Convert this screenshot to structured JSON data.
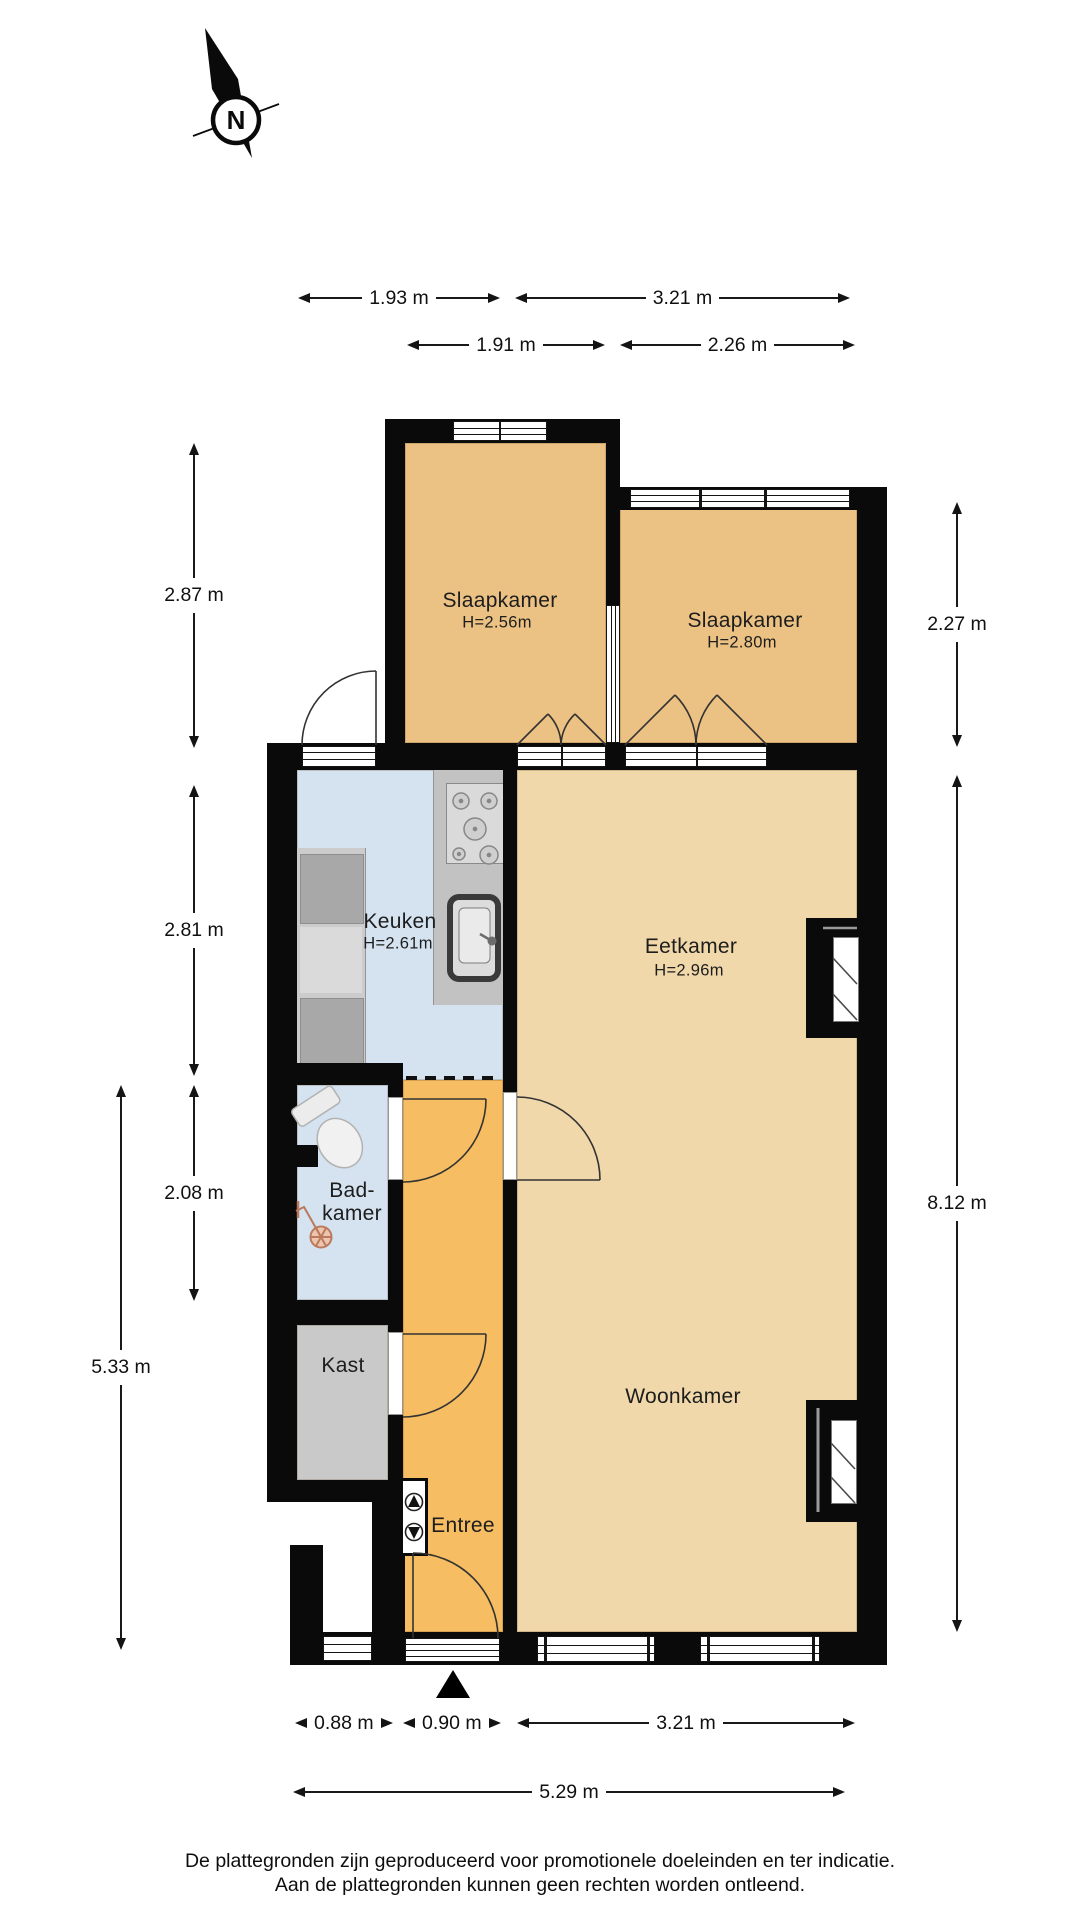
{
  "compass": {
    "letter": "N"
  },
  "rooms": {
    "slaapkamer1": {
      "name": "Slaapkamer",
      "ceiling": "H=2.56m"
    },
    "slaapkamer2": {
      "name": "Slaapkamer",
      "ceiling": "H=2.80m"
    },
    "keuken": {
      "name": "Keuken",
      "ceiling": "H=2.61m"
    },
    "eetkamer": {
      "name": "Eetkamer",
      "ceiling": "H=2.96m"
    },
    "badkamer": {
      "name_line1": "Bad-",
      "name_line2": "kamer"
    },
    "kast": {
      "name": "Kast"
    },
    "woonkamer": {
      "name": "Woonkamer"
    },
    "entree": {
      "name": "Entree"
    }
  },
  "dimensions": {
    "top_row1_left": "1.93 m",
    "top_row1_right": "3.21 m",
    "top_row2_left": "1.91 m",
    "top_row2_right": "2.26 m",
    "left_bedroom": "2.87 m",
    "left_kitchen": "2.81 m",
    "left_bathroom": "2.08 m",
    "left_total": "5.33 m",
    "right_bedroom": "2.27 m",
    "right_living": "8.12 m",
    "bottom_window": "0.88 m",
    "bottom_door": "0.90 m",
    "bottom_living": "3.21 m",
    "bottom_total": "5.29 m"
  },
  "footer": {
    "line1": "De plattegronden zijn geproduceerd voor promotionele doeleinden en ter indicatie.",
    "line2": "Aan de plattegronden kunnen geen rechten worden ontleend."
  },
  "colors": {
    "wall": "#0a0a0a",
    "bedroom_floor": "#ebc283",
    "living_floor": "#f0d8aa",
    "hall_floor": "#f6bd62",
    "wet_room_floor": "#d5e3f1",
    "closet_floor": "#c9c9c9"
  },
  "icons": {
    "north_compass": "north-arrow-with-circle-N",
    "entrance_marker": "solid-black-triangle"
  }
}
